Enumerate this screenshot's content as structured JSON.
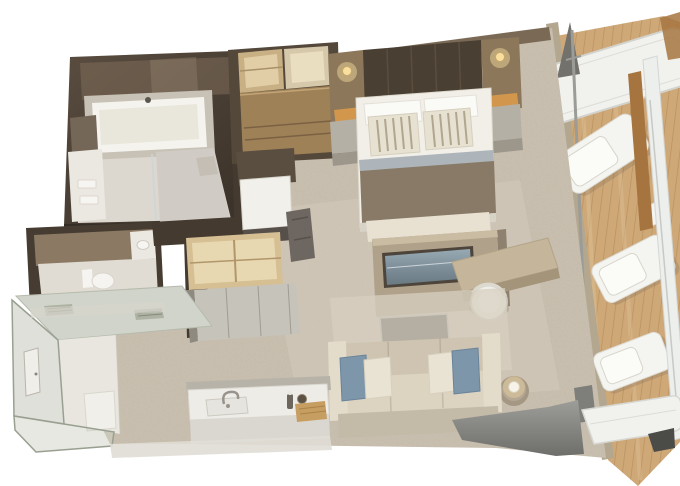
{
  "meta": {
    "subject": "3D isometric floor plan rendering of a suite with private balcony",
    "style": "photorealistic architectural cutaway render, no visible text",
    "background": "#ffffff"
  },
  "rooms": [
    {
      "id": "bathroom",
      "label": "Master bathroom",
      "furniture": [
        "bathtub",
        "vanity with towels",
        "walk-in shower",
        "mirror"
      ]
    },
    {
      "id": "powder-room",
      "label": "Second bathroom",
      "furniture": [
        "toilet",
        "vanity sink"
      ]
    },
    {
      "id": "walk-in-closet",
      "label": "Walk-in closet",
      "furniture": [
        "open shelves",
        "drawer cabinet",
        "white-top dresser",
        "wardrobe shelves",
        "cabinet doors",
        "luggage stand"
      ]
    },
    {
      "id": "bedroom",
      "label": "Bedroom",
      "furniture": [
        "king bed",
        "striped pillows",
        "bed runner",
        "nightstands",
        "wall sconces",
        "foot bench",
        "tv partition wall",
        "television"
      ]
    },
    {
      "id": "living-area",
      "label": "Living area",
      "furniture": [
        "sofa",
        "blue accent pillows",
        "coffee table",
        "side table with lamp",
        "desk",
        "barrel chair",
        "area rug"
      ]
    },
    {
      "id": "wet-bar",
      "label": "Wet bar",
      "furniture": [
        "counter",
        "faucet and sink",
        "bottle",
        "wooden tray",
        "bowl"
      ]
    },
    {
      "id": "entry-hall",
      "label": "Entry hall",
      "furniture": [
        "entry door",
        "glass walls",
        "ceiling vents",
        "floor mat"
      ]
    },
    {
      "id": "balcony",
      "label": "Private balcony",
      "furniture": [
        "teak deck",
        "lounge chairs",
        "deck table",
        "privacy divider sail",
        "railing",
        "wood posts",
        "upper canopy"
      ]
    }
  ],
  "colors": {
    "bg": "#ffffff",
    "carpet": "#cbc1b1",
    "carpetSheen": "#dad2c2",
    "slabEdge": "#e0ddd6",
    "slabEdge2": "#d8d5cd",
    "bathWall": "#4a3f34",
    "bathWallLight": "#7d6c5a",
    "bathHighlight": "#93826f",
    "tubDeck": "#c8c1b5",
    "tub": "#f4f3ee",
    "tubInner": "#e9e7dc",
    "bathFloor": "#dcd7cf",
    "vanity": "#ebe8e2",
    "mirror": "#756757",
    "showerFloor": "#d0ccc5",
    "showerBench": "#c4beb4",
    "wallBase": "#352e27",
    "powderFrame": "#463c31",
    "powderWall": "#8b7964",
    "powderFloor": "#e1dcd3",
    "fixtureWhite": "#f5f4f0",
    "wallDark": "#443a30",
    "closetFrame": "#54483b",
    "closetShelf": "#c8b084",
    "closetBack": "#e2cea6",
    "closetShelfB": "#d5c8ab",
    "closetBackB": "#eadec0",
    "closetCabinet": "#9f8158",
    "closetShadow": "#5a4e41",
    "dresserTop": "#f1f0eb",
    "dresserFront": "#57504a",
    "darkObject": "#6e6761",
    "wardrobeShelf": "#d6bf93",
    "wardrobeBack": "#e8d8b1",
    "wardrobeDoor": "#c6c3ba",
    "wardrobeSide": "#8e8a80",
    "ledge": "#7a6a55",
    "sconce": "#8c775a",
    "lamp": "#f8dfa0",
    "niche": "#d99a4b",
    "headboard": "#4a3f33",
    "headboardSeam": "#5b4e3f",
    "nightstand": "#b5b0a6",
    "nightstandFront": "#9c968b",
    "bed": "#f1efe8",
    "pillowWhite": "#fafaf6",
    "pillow": "#e7e1d2",
    "pillowStripe": "#b1a68e",
    "blueStripe": "#adb5ba",
    "runner": "#887a67",
    "bedFront": "#d8d3c7",
    "bench": "#e8e1d2",
    "benchFront": "#cec6b5",
    "benchLeg": "#5f594f",
    "tvWall": "#b0a28a",
    "tvWallTop": "#c9bca2",
    "tvWallSide": "#8e8170",
    "tvFrame": "#4d453b",
    "desk": "#c5b69b",
    "deskFront": "#a3947a",
    "stool": "#efeee8",
    "stoolInner": "#f7f6f2",
    "rug": "#d7cfc0",
    "coffeeTable": "#b5afa3",
    "sideTable": "#a49783",
    "sideTableTop": "#b4a794",
    "lampWhite": "#f7f3e8",
    "sofaBack": "#cec4b1",
    "sofaSeat": "#dcd3c1",
    "sofaFront": "#c3baa7",
    "armrest": "#e4dccb",
    "bluePillow": "#7d96aa",
    "creamPillow": "#e9e3d4",
    "counterBack": "#b8b3a9",
    "counterTop": "#eeece7",
    "counterFront": "#dad7d0",
    "sinkInset": "#e6e4de",
    "faucet": "#98948c",
    "tray": "#c79e62",
    "bottle": "#6c665d",
    "bowl": "#5c5244",
    "entryRoof": "#d1d4ca",
    "vent": "#adb2a3",
    "entryFloor": "#e9e6df",
    "mat": "#f1efe9",
    "entryGlass": "#c2c7b9",
    "entryGlassB": "#cdd2c4",
    "door": "#f0eee8",
    "extWall": "#b3a78f",
    "doorGlass": "#ccd5d7",
    "deckWood": "#cfa878",
    "plankLight": "#dcbf93",
    "canopy": "#f1f1ee",
    "canopyEdge": "#d3d3ce",
    "sail": "#73716c",
    "pole": "#9b9b97",
    "poleBase": "#7e7e7a",
    "lounger": "#f4f4f0",
    "woodPost": "#a6753f",
    "railWhite": "#edefed",
    "platform": "#f1f1ee",
    "darkWedge": "#4b4b47"
  }
}
